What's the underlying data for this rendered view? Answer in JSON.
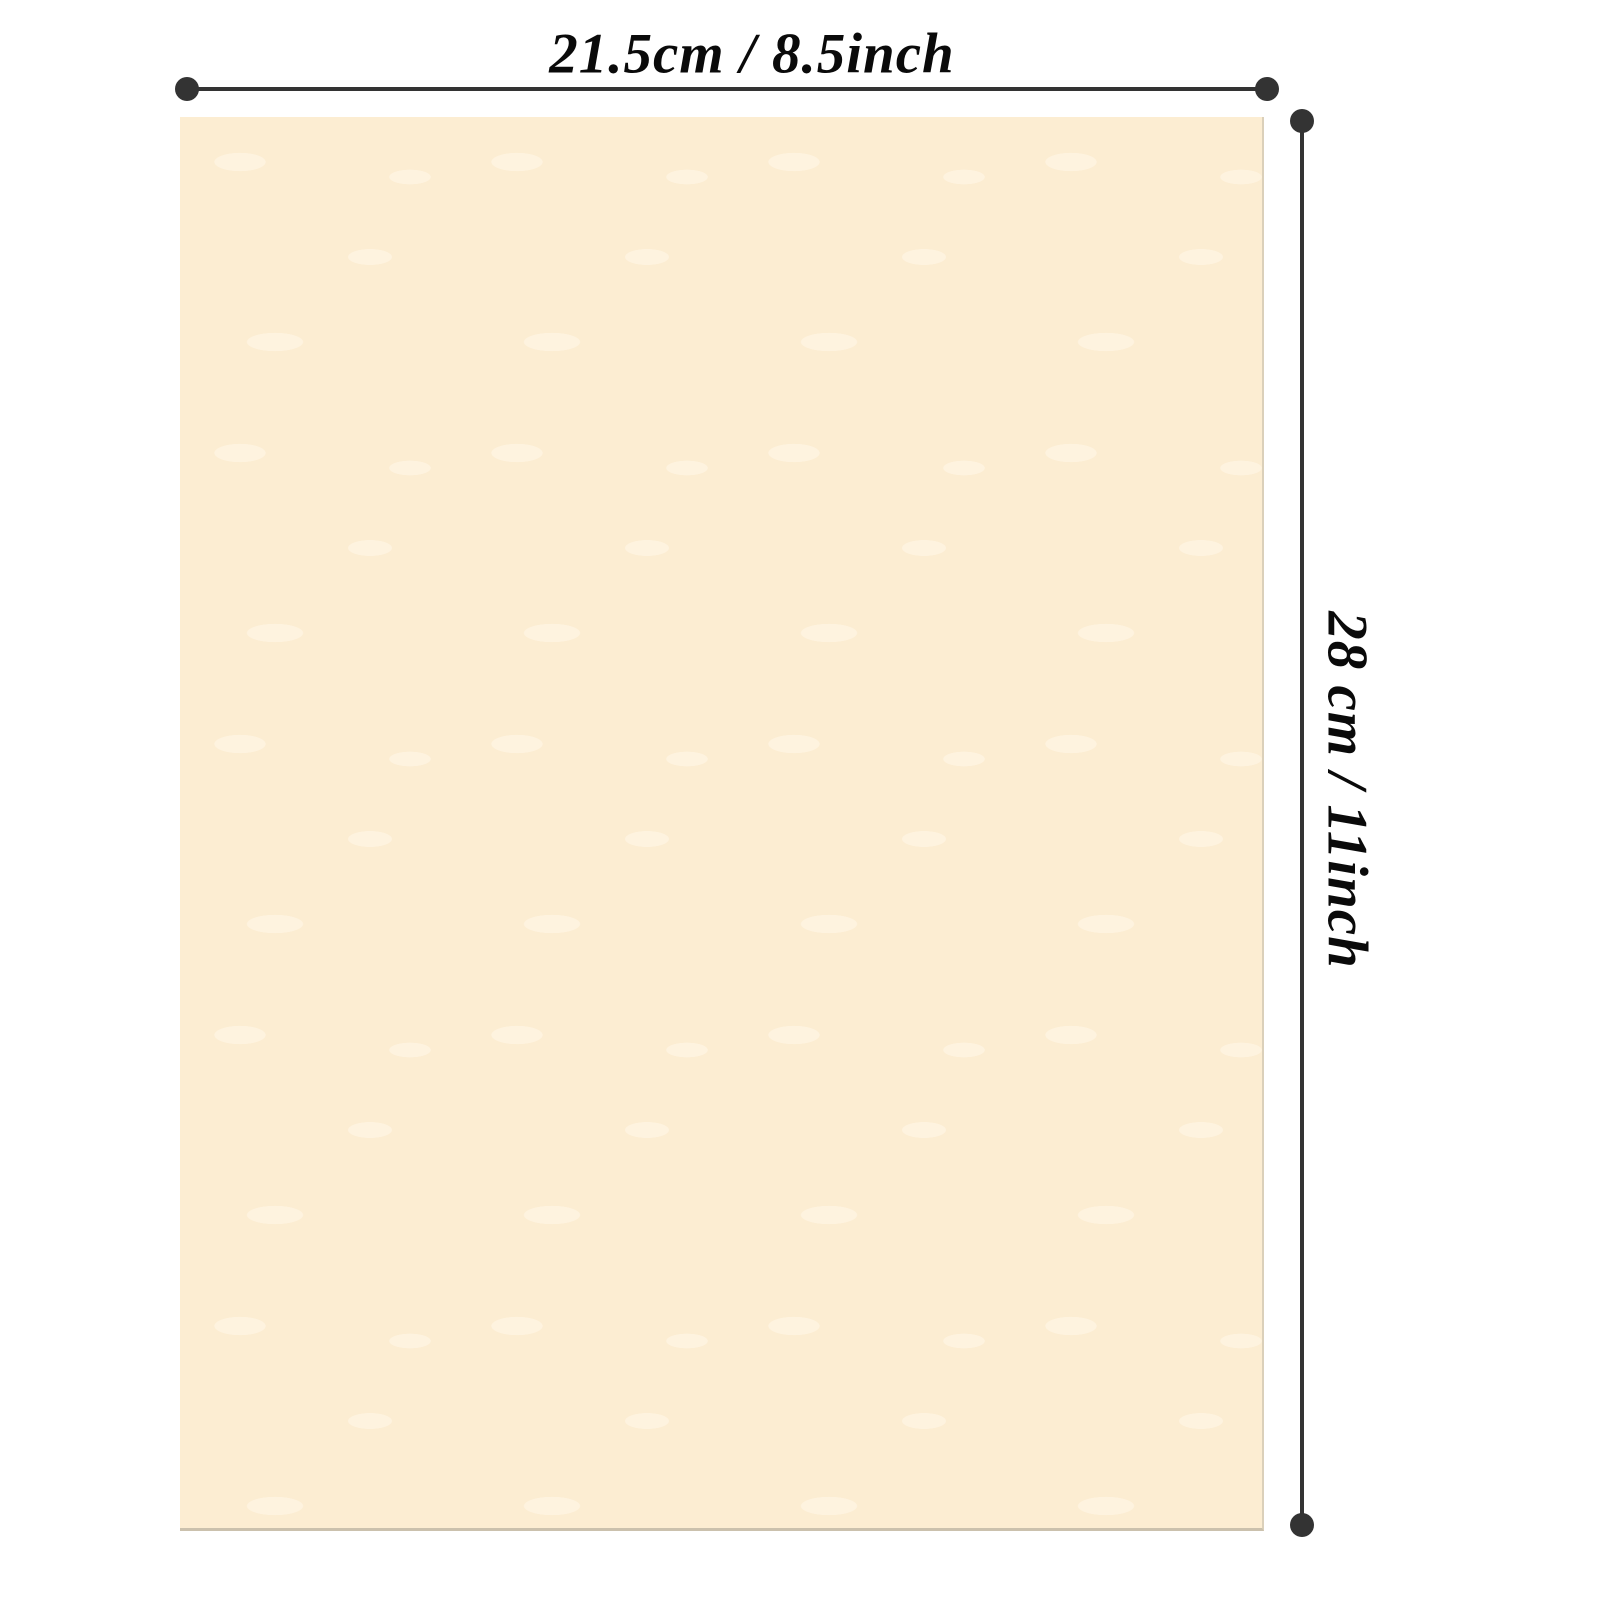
{
  "figure": {
    "width_label": "21.5cm / 8.5inch",
    "height_label": "28 cm / 11inch"
  },
  "icons": {
    "endpoint_dot": "circle-endpoint-marker"
  },
  "colors": {
    "bg": "#FFFFFF",
    "paper": "#FCEDD2",
    "paper_spot": "#FEF3DF",
    "edge_right": "#DBD0BA",
    "edge_bottom": "#CBC1AD",
    "dim": "#333333",
    "text": "#0A0A0A"
  }
}
